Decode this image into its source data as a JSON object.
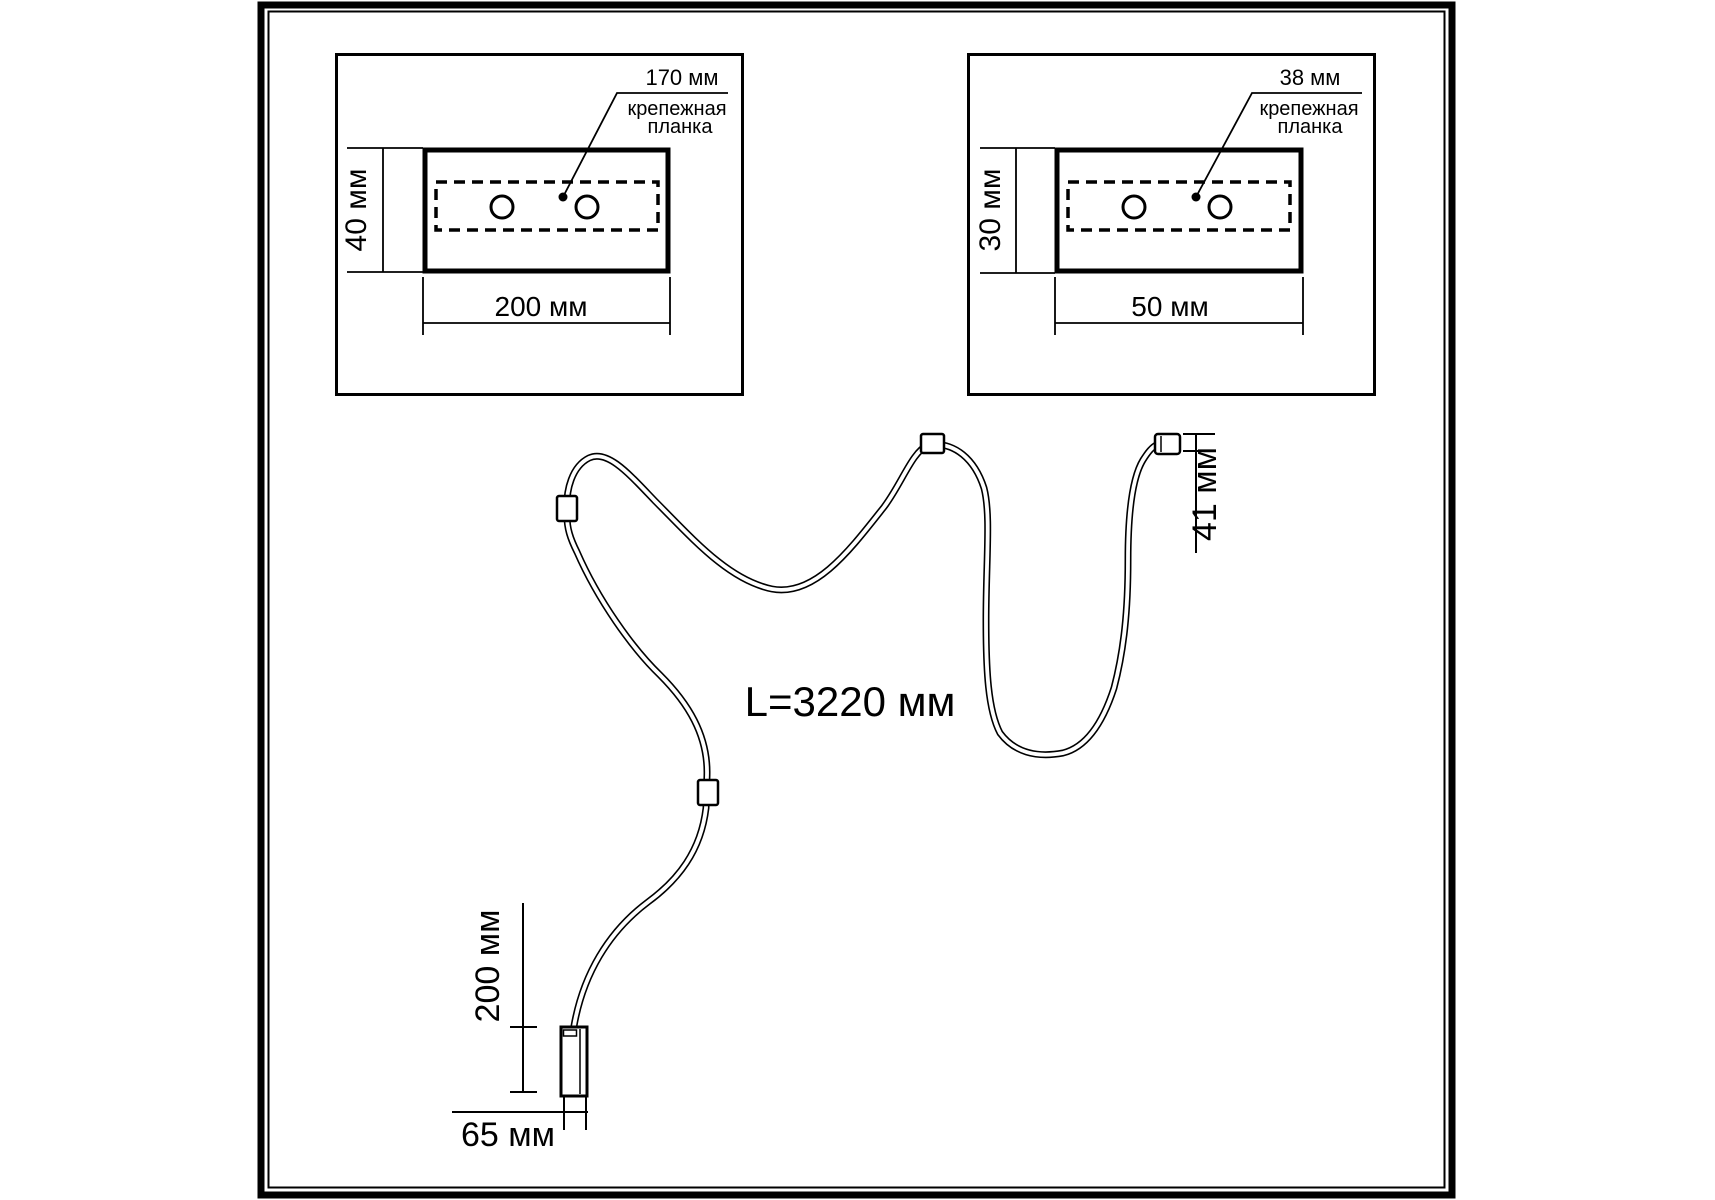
{
  "plate_large": {
    "spacing": "170 мм",
    "callout_line1": "крепежная",
    "callout_line2": "планка",
    "height": "40 мм",
    "width": "200 мм"
  },
  "plate_small": {
    "spacing": "38 мм",
    "callout_line1": "крепежная",
    "callout_line2": "планка",
    "height": "30 мм",
    "width": "50 мм"
  },
  "cable": {
    "total_length": "L=3220 мм",
    "end_fitting_length": "41 мм",
    "wand_length": "200 мм",
    "wand_width": "65 мм"
  },
  "colors": {
    "ink": "#000000",
    "paper": "#ffffff"
  }
}
